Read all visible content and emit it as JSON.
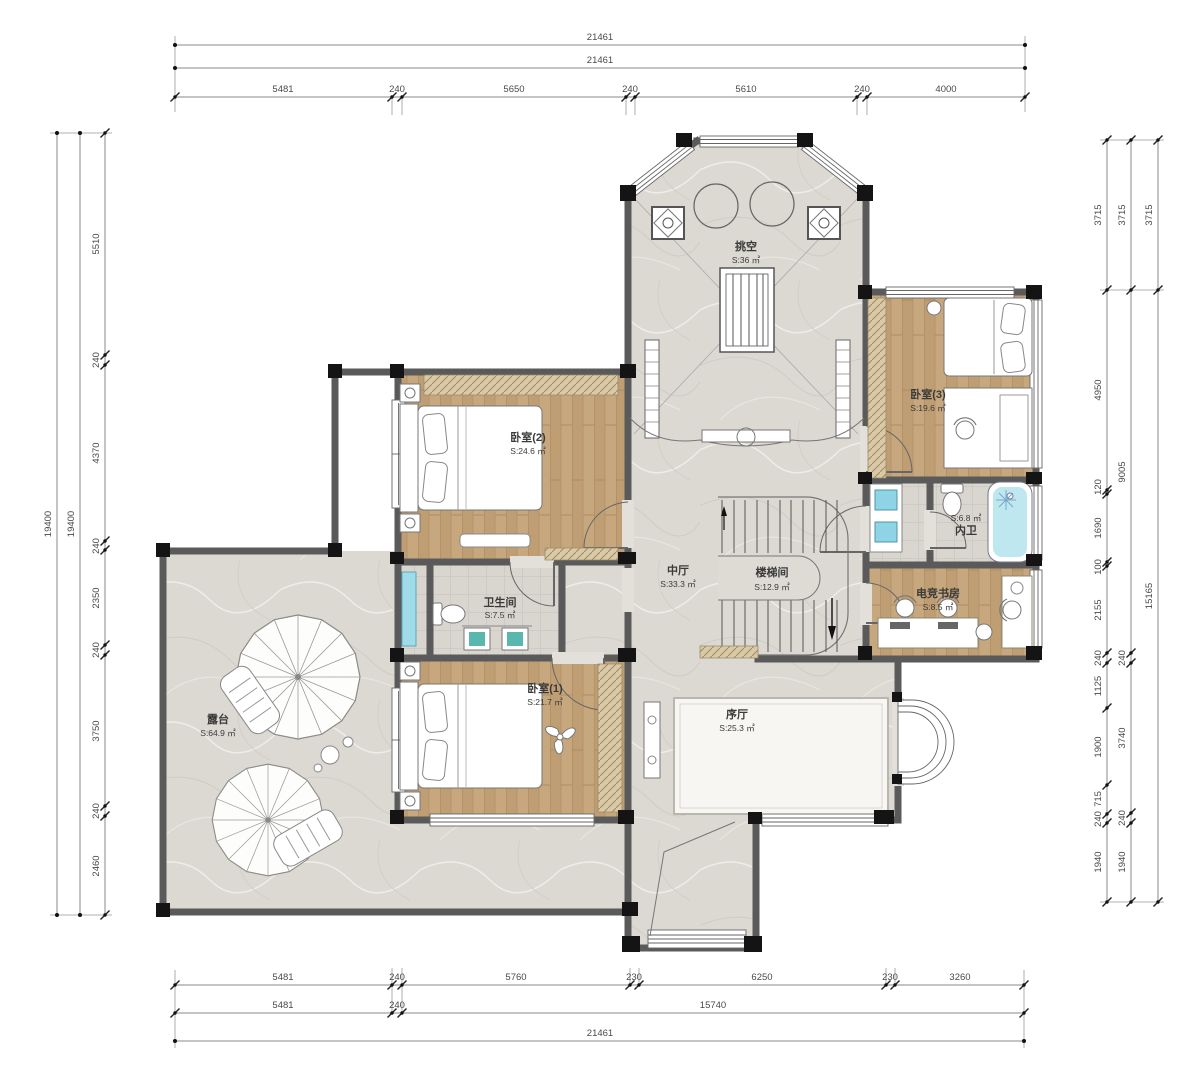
{
  "rooms": {
    "void": {
      "name": "挑空",
      "area": "S:36 ㎡"
    },
    "bedroom2": {
      "name": "卧室(2)",
      "area": "S:24.6 ㎡"
    },
    "bedroom3": {
      "name": "卧室(3)",
      "area": "S:19.6 ㎡"
    },
    "hall": {
      "name": "中厅",
      "area": "S:33.3 ㎡"
    },
    "stairwell": {
      "name": "楼梯间",
      "area": "S:12.9 ㎡"
    },
    "inner_bath": {
      "name": "内卫",
      "area": "S:6.8 ㎡"
    },
    "study": {
      "name": "电竞书房",
      "area": "S:8.5 ㎡"
    },
    "bathroom": {
      "name": "卫生间",
      "area": "S:7.5 ㎡"
    },
    "bedroom1": {
      "name": "卧室(1)",
      "area": "S:21.7 ㎡"
    },
    "foyer": {
      "name": "序厅",
      "area": "S:25.3 ㎡"
    },
    "terrace": {
      "name": "露台",
      "area": "S:64.9 ㎡"
    }
  },
  "dims": {
    "top": {
      "total_outer": "21461",
      "total_inner": "21461",
      "segments": [
        "5481",
        "240",
        "5650",
        "240",
        "5610",
        "240",
        "4000"
      ]
    },
    "bottom": {
      "segments": [
        "5481",
        "240",
        "5760",
        "230",
        "6250",
        "230",
        "3260"
      ],
      "mid": [
        "5481",
        "240",
        "15740"
      ],
      "total": "21461"
    },
    "left": {
      "total_outer": "19400",
      "total_inner": "19400",
      "segments": [
        "5510",
        "240",
        "4370",
        "240",
        "2350",
        "240",
        "3750",
        "240",
        "2460"
      ]
    },
    "right": {
      "inner": [
        "3715",
        "4950",
        "120",
        "1690",
        "100",
        "2155",
        "240",
        "1125",
        "1900",
        "715",
        "240",
        "1940"
      ],
      "mid": [
        "3715",
        "9005",
        "240",
        "3740",
        "240",
        "1940"
      ],
      "outer": [
        "3715",
        "15165"
      ]
    }
  },
  "colors": {
    "wall": "#5a5a5a",
    "column": "#141414",
    "wood": "#c7a77e",
    "marble": "#dcd9d3",
    "water": "#9fdbe9",
    "cabinet": "#d9c9a7"
  }
}
